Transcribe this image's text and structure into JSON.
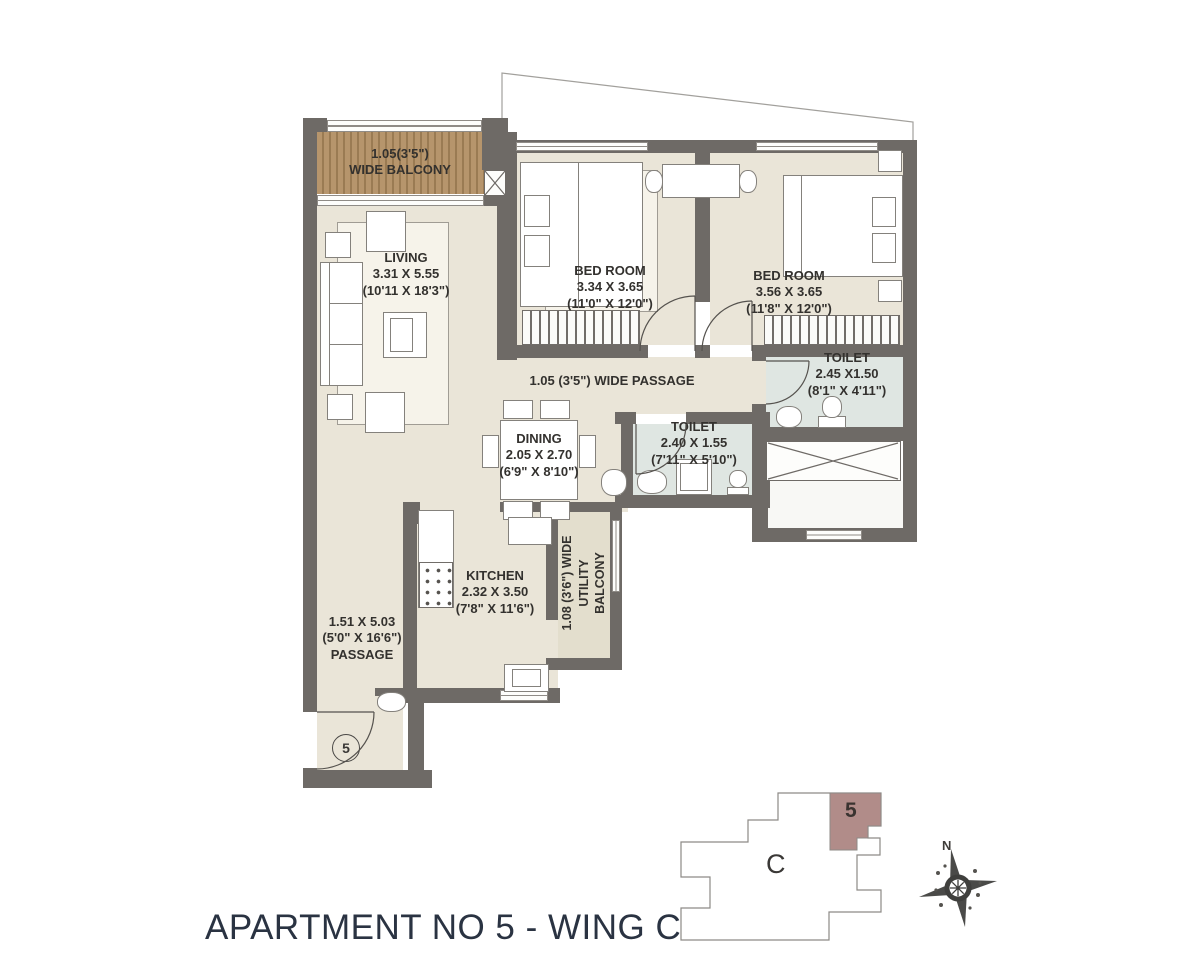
{
  "title": "APARTMENT NO 5 - WING C",
  "colors": {
    "wall": "#6e6a66",
    "floor_beige": "#eae5d8",
    "toilet_floor": "#dfe6e2",
    "balcony_wood": "#b6956c",
    "title_text": "#2a3342"
  },
  "rooms": {
    "balcony": {
      "line1": "1.05(3'5\")",
      "line2": "WIDE BALCONY"
    },
    "living": {
      "name": "LIVING",
      "dim_m": "3.31 X 5.55",
      "dim_ft": "(10'11 X 18'3\")"
    },
    "bedroom1": {
      "name": "BED ROOM",
      "dim_m": "3.34 X 3.65",
      "dim_ft": "(11'0\" X 12'0\")"
    },
    "bedroom2": {
      "name": "BED ROOM",
      "dim_m": "3.56 X 3.65",
      "dim_ft": "(11'8\" X 12'0\")"
    },
    "toilet1": {
      "name": "TOILET",
      "dim_m": "2.45 X1.50",
      "dim_ft": "(8'1\" X 4'11\")"
    },
    "toilet2": {
      "name": "TOILET",
      "dim_m": "2.40 X 1.55",
      "dim_ft": "(7'11\" X 5'10\")"
    },
    "wide_passage": {
      "label": "1.05 (3'5\") WIDE PASSAGE"
    },
    "dining": {
      "name": "DINING",
      "dim_m": "2.05 X 2.70",
      "dim_ft": "(6'9\" X 8'10\")"
    },
    "kitchen": {
      "name": "KITCHEN",
      "dim_m": "2.32 X 3.50",
      "dim_ft": "(7'8\" X 11'6\")"
    },
    "utility": {
      "line1": "1.08 (3'6\") WIDE",
      "line2": "UTILITY",
      "line3": "BALCONY"
    },
    "passage": {
      "dim_m": "1.51 X 5.03",
      "dim_ft": "(5'0\" X 16'6\")",
      "name": "PASSAGE"
    },
    "entrance_number": "5"
  },
  "key_plan": {
    "wing_label": "C",
    "unit_label": "5",
    "highlight_color": "#b18c89"
  },
  "compass": {
    "north_label": "N"
  }
}
